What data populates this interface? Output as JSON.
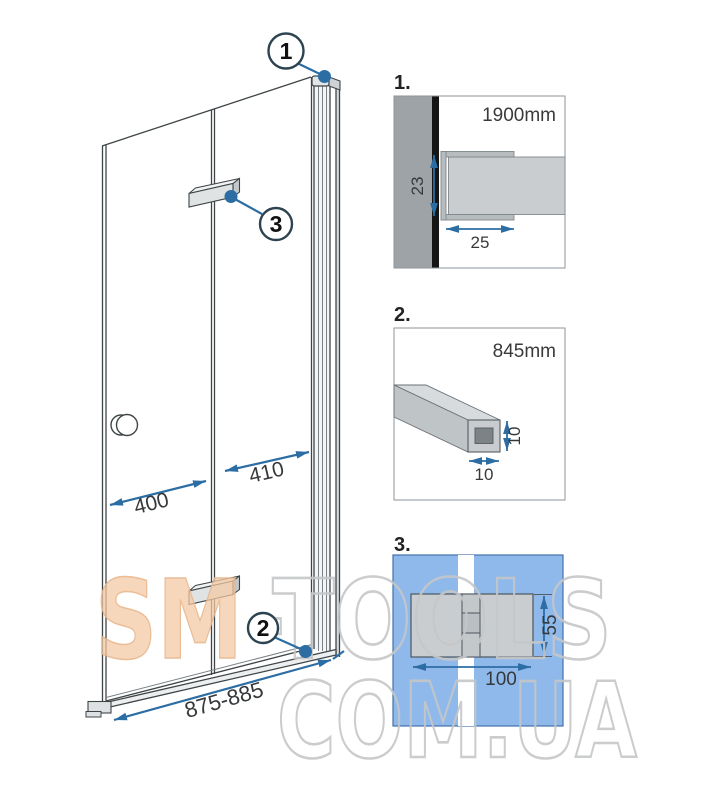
{
  "main_drawing": {
    "callout_1": "1",
    "callout_2": "2",
    "callout_3": "3",
    "dim_left_panel": "400",
    "dim_right_panel": "410",
    "dim_total_width": "875-885"
  },
  "details": {
    "d1": {
      "label": "1.",
      "length": "1900mm",
      "dim_depth": "23",
      "dim_width": "25"
    },
    "d2": {
      "label": "2.",
      "length": "845mm",
      "dim_height": "10",
      "dim_width": "10"
    },
    "d3": {
      "label": "3.",
      "dim_height": "55",
      "dim_width": "100"
    }
  },
  "watermark": {
    "part1": "SM",
    "part2": "-TOOLS",
    "line2": "COM.UA"
  },
  "colors": {
    "dimension_blue": "#2c6da4",
    "callout_stroke": "#2d4450",
    "panel_blue": "#8fb9ea",
    "watermark_peach": "#f4c9a4",
    "watermark_gray": "#c5c7c8",
    "wall_gray": "#9da3a6",
    "glass_gray": "#c9cdcf"
  }
}
